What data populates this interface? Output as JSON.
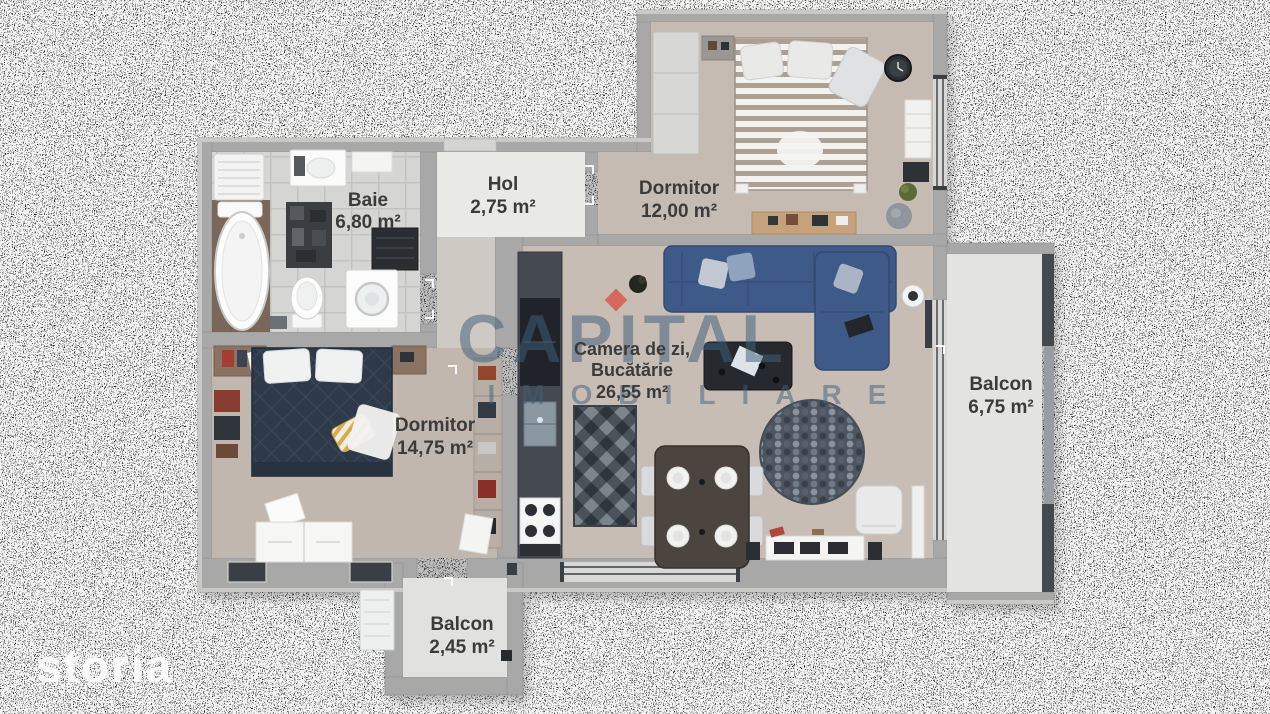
{
  "watermark": {
    "brand": "CAPITAL",
    "tagline": "IMOBILIARE"
  },
  "logo": {
    "text": "storia"
  },
  "rooms": {
    "baie": {
      "name": "Baie",
      "area": "6,80 m²"
    },
    "hol": {
      "name": "Hol",
      "area": "2,75 m²"
    },
    "dormitor_mic": {
      "name": "Dormitor",
      "area": "12,00 m²"
    },
    "living": {
      "name_line1": "Camera de zi,",
      "name_line2": "Bucătărie",
      "area": "26,55 m²"
    },
    "dormitor_mare": {
      "name": "Dormitor",
      "area": "14,75 m²"
    },
    "balcon_mare": {
      "name": "Balcon",
      "area": "6,75 m²"
    },
    "balcon_mic": {
      "name": "Balcon",
      "area": "2,45 m²"
    }
  },
  "colors": {
    "wall": "#a8a8a8",
    "wall_dark_frame": "#3a3f45",
    "floor_living": "#c8bdb5",
    "floor_hall": "#e9eae6",
    "floor_balcony": "#e3e4e1",
    "sofa_navy": "#3e5a88",
    "bed_navy": "#2e3a4a",
    "label_text": "#3b3b3b",
    "watermark_blue": "#3e617c",
    "watermark_accent": "#d95a4c",
    "logo_white": "#ffffff"
  }
}
